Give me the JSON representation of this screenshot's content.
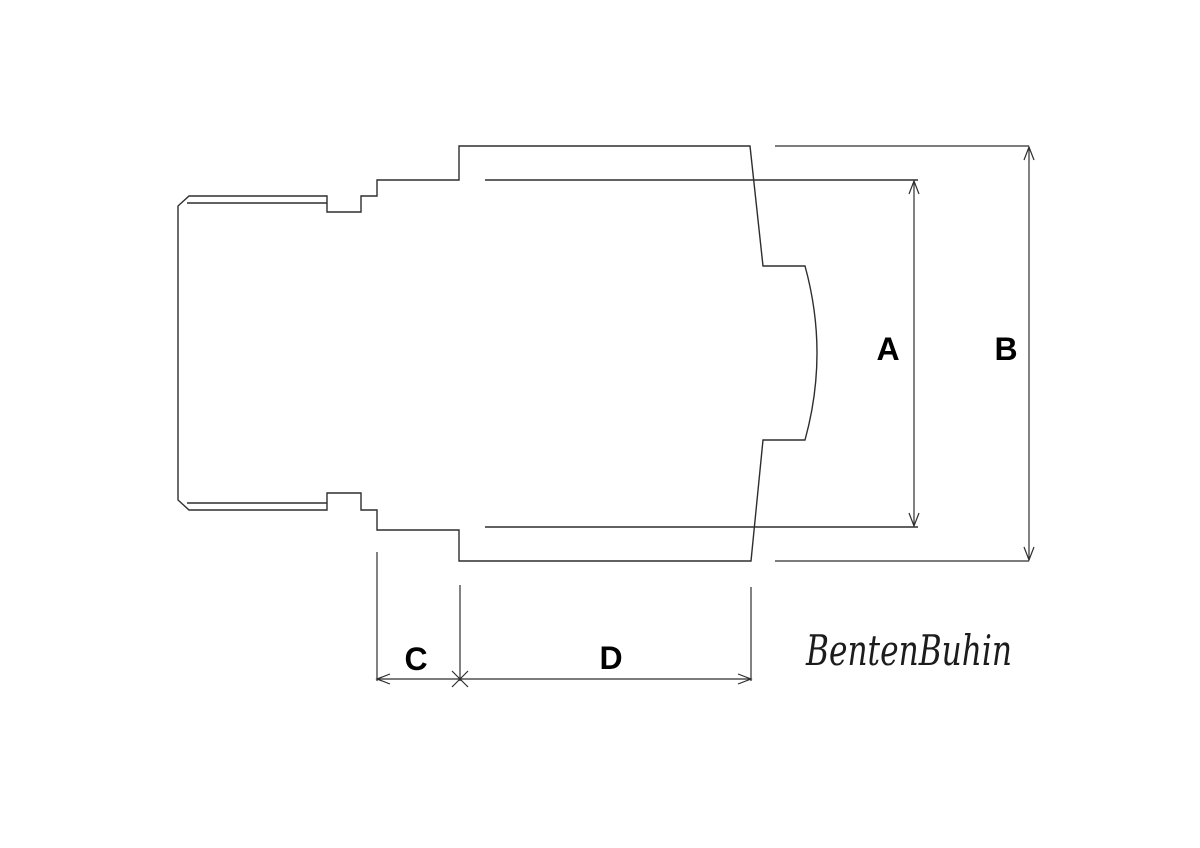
{
  "colors": {
    "background": "#ffffff",
    "line": "#2e2e2e",
    "label": "#000000",
    "brand": "#1c1c1c"
  },
  "labels": {
    "dim_a": "A",
    "dim_b": "B",
    "dim_c": "C",
    "dim_d": "D"
  },
  "brand": {
    "text": "BentenBuhin"
  }
}
